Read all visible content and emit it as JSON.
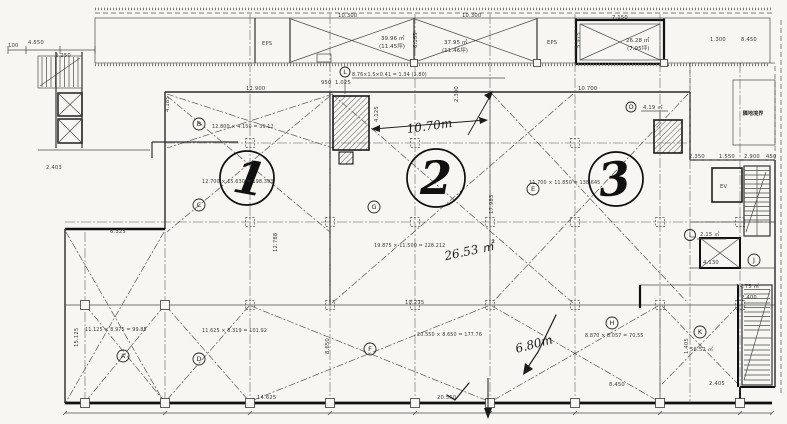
{
  "colors": {
    "paper": "#f7f6f2",
    "ink": "#3b3b3b",
    "ink_heavy": "#111111"
  },
  "annotations": [
    {
      "n": "dim-100",
      "t": "100",
      "x": 8,
      "y": 47,
      "c": "dim"
    },
    {
      "n": "dim-4550",
      "t": "4.550",
      "x": 28,
      "y": 44,
      "c": "dim"
    },
    {
      "n": "dim-2250",
      "t": "2.250",
      "x": 55,
      "y": 57,
      "c": "dim"
    },
    {
      "n": "dim-10300-a",
      "t": "10.300",
      "x": 338,
      "y": 17,
      "c": "dim"
    },
    {
      "n": "dim-10300-b",
      "t": "10.300",
      "x": 462,
      "y": 17,
      "c": "dim"
    },
    {
      "n": "area-bay-a",
      "t": "39.96 ㎡",
      "x": 381,
      "y": 40,
      "c": "area"
    },
    {
      "n": "area-bay-a-tsubo",
      "t": "(11.45坪)",
      "x": 379,
      "y": 48,
      "c": "area"
    },
    {
      "n": "area-bay-b",
      "t": "37.95 ㎡",
      "x": 444,
      "y": 44,
      "c": "area"
    },
    {
      "n": "area-bay-b-tsubo",
      "t": "(11.46坪)",
      "x": 442,
      "y": 52,
      "c": "area"
    },
    {
      "n": "label-eps-left",
      "t": "EPS",
      "x": 262,
      "y": 45,
      "c": "dim"
    },
    {
      "n": "label-eps-mid",
      "t": "EPS",
      "x": 547,
      "y": 44,
      "c": "dim"
    },
    {
      "n": "dim-7150",
      "t": "7.150",
      "x": 612,
      "y": 19,
      "c": "dim"
    },
    {
      "n": "dim-5975",
      "t": "5.975",
      "x": 580,
      "y": 48,
      "c": "dimv"
    },
    {
      "n": "area-box",
      "t": "26.28 ㎡",
      "x": 626,
      "y": 42,
      "c": "area"
    },
    {
      "n": "area-box-tsubo",
      "t": "(7.95坪)",
      "x": 627,
      "y": 50,
      "c": "area"
    },
    {
      "n": "dim-6155",
      "t": "6.155",
      "x": 417,
      "y": 48,
      "c": "dimv"
    },
    {
      "n": "dim-1300",
      "t": "1.300",
      "x": 710,
      "y": 41,
      "c": "dim"
    },
    {
      "n": "dim-8450-top",
      "t": "8.450",
      "x": 741,
      "y": 41,
      "c": "dim"
    },
    {
      "n": "label-kanji-box",
      "t": "隣地境界",
      "x": 753,
      "y": 115,
      "c": "kanji"
    },
    {
      "n": "dim-12900",
      "t": "12.900",
      "x": 246,
      "y": 90,
      "c": "dim"
    },
    {
      "n": "dim-4185",
      "t": "4.185",
      "x": 169,
      "y": 112,
      "c": "dimv"
    },
    {
      "n": "formula-bay-b",
      "t": "12.800 × 4.150 = 39.12",
      "x": 212,
      "y": 128,
      "c": "formula"
    },
    {
      "n": "dim-10700",
      "t": "10.700",
      "x": 578,
      "y": 90,
      "c": "dim"
    },
    {
      "n": "area-shaft-right",
      "t": "4.19 ㎡",
      "x": 643,
      "y": 109,
      "c": "dim"
    },
    {
      "n": "dim-2350",
      "t": "2.350",
      "x": 689,
      "y": 158,
      "c": "dim"
    },
    {
      "n": "dim-1550",
      "t": "1.550",
      "x": 719,
      "y": 158,
      "c": "dim"
    },
    {
      "n": "dim-2900",
      "t": "2.900",
      "x": 744,
      "y": 158,
      "c": "dim"
    },
    {
      "n": "dim-450",
      "t": "450",
      "x": 766,
      "y": 158,
      "c": "dim"
    },
    {
      "n": "shaft-annotation",
      "t": "8.76×1.5×0.41 = 1.34 (3.80)",
      "x": 352,
      "y": 76,
      "c": "formula"
    },
    {
      "n": "dim-950",
      "t": "950",
      "x": 321,
      "y": 84,
      "c": "dim"
    },
    {
      "n": "dim-1025",
      "t": "1.025",
      "x": 335,
      "y": 84,
      "c": "dim"
    },
    {
      "n": "dim-2300",
      "t": "2.300",
      "x": 458,
      "y": 102,
      "c": "dimv"
    },
    {
      "n": "dim-4125",
      "t": "4.125",
      "x": 378,
      "y": 122,
      "c": "dimv"
    },
    {
      "n": "hand-1070",
      "t": "10.70m",
      "x": 430,
      "y": 130,
      "c": "hand",
      "rot": -8
    },
    {
      "n": "zone-circle-1",
      "t": "1",
      "x": 247,
      "y": 194,
      "cy": 178,
      "r": 27,
      "c": "big",
      "rot": 10
    },
    {
      "n": "zone-circle-2",
      "t": "2",
      "x": 436,
      "y": 194,
      "cy": 178,
      "r": 29,
      "c": "big"
    },
    {
      "n": "zone-circle-3",
      "t": "3",
      "x": 616,
      "y": 195,
      "cy": 179,
      "r": 27,
      "c": "big",
      "rot": -6
    },
    {
      "n": "formula-zone-1",
      "t": "12.700 × 15.630 = 198.393",
      "x": 202,
      "y": 183,
      "c": "formula"
    },
    {
      "n": "formula-zone-2",
      "t": "19.875 × 11.500 = 228.212",
      "x": 374,
      "y": 247,
      "c": "formula"
    },
    {
      "n": "formula-zone-3",
      "t": "11.700 × 11.850 = 138.645",
      "x": 529,
      "y": 184,
      "c": "formula"
    },
    {
      "n": "area-room-i",
      "t": "2.15 ㎡",
      "x": 700,
      "y": 236,
      "c": "dim"
    },
    {
      "n": "dim-4130",
      "t": "4.130",
      "x": 703,
      "y": 264,
      "c": "dim"
    },
    {
      "n": "area-room-j",
      "t": "14.75 ㎡",
      "x": 736,
      "y": 288,
      "c": "dim"
    },
    {
      "n": "dim-2400",
      "t": "2.400",
      "x": 741,
      "y": 299,
      "c": "dim"
    },
    {
      "n": "area-room-k",
      "t": "56.52 ㎡",
      "x": 690,
      "y": 351,
      "c": "dim"
    },
    {
      "n": "dim-8450-bottom",
      "t": "8.450",
      "x": 609,
      "y": 386,
      "c": "dim"
    },
    {
      "n": "dim-2405",
      "t": "2.405",
      "x": 709,
      "y": 385,
      "c": "dim"
    },
    {
      "n": "hand-2653",
      "t": "26.53 ㎡",
      "x": 470,
      "y": 255,
      "c": "hand",
      "rot": -12
    },
    {
      "n": "hand-680",
      "t": "6.80m",
      "x": 535,
      "y": 348,
      "c": "hand",
      "rot": -15
    },
    {
      "n": "dim-10275",
      "t": "10.275",
      "x": 405,
      "y": 304,
      "c": "dim"
    },
    {
      "n": "dim-8650",
      "t": "8.650",
      "x": 329,
      "y": 354,
      "c": "dimv"
    },
    {
      "n": "dim-14625",
      "t": "14.625",
      "x": 257,
      "y": 399,
      "c": "dim"
    },
    {
      "n": "dim-20550",
      "t": "20.550",
      "x": 437,
      "y": 399,
      "c": "dim"
    },
    {
      "n": "formula-bay-a2",
      "t": "11.125 × 8.975 = 99.85",
      "x": 85,
      "y": 331,
      "c": "formula"
    },
    {
      "n": "formula-bay-d",
      "t": "11.625 × 8.319 = 101.92",
      "x": 202,
      "y": 332,
      "c": "formula"
    },
    {
      "n": "formula-bay-f",
      "t": "20.550 × 8.650 = 177.76",
      "x": 417,
      "y": 336,
      "c": "formula"
    },
    {
      "n": "formula-bay-h",
      "t": "8.870 × 8.057 = 70.55",
      "x": 585,
      "y": 337,
      "c": "formula"
    },
    {
      "n": "dim-15125",
      "t": "15.125",
      "x": 78,
      "y": 347,
      "c": "dimv"
    },
    {
      "n": "dim-12788",
      "t": "12.788",
      "x": 277,
      "y": 252,
      "c": "dimv"
    },
    {
      "n": "dim-17983",
      "t": "17.983",
      "x": 493,
      "y": 214,
      "c": "dimv"
    },
    {
      "n": "dim-6325",
      "t": "6.325",
      "x": 110,
      "y": 233,
      "c": "dim"
    },
    {
      "n": "dim-2403",
      "t": "2.403",
      "x": 46,
      "y": 169,
      "c": "dim"
    },
    {
      "n": "label-ev",
      "t": "EV",
      "x": 720,
      "y": 188,
      "c": "dim"
    },
    {
      "n": "dim-1405",
      "t": "1.405",
      "x": 688,
      "y": 354,
      "c": "dimv"
    },
    {
      "n": "grid-letter-l",
      "t": "L",
      "x": 345,
      "y": 74,
      "c": "letter",
      "r": 5
    },
    {
      "n": "grid-letter-b",
      "t": "B",
      "x": 199,
      "y": 126,
      "c": "letter",
      "r": 6
    },
    {
      "n": "grid-letter-c",
      "t": "C",
      "x": 199,
      "y": 207,
      "c": "letter",
      "r": 6
    },
    {
      "n": "grid-letter-g",
      "t": "G",
      "x": 374,
      "y": 209,
      "c": "letter",
      "r": 6
    },
    {
      "n": "grid-letter-e",
      "t": "E",
      "x": 533,
      "y": 191,
      "c": "letter",
      "r": 6
    },
    {
      "n": "grid-letter-o",
      "t": "O",
      "x": 631,
      "y": 109,
      "c": "letter",
      "r": 5
    },
    {
      "n": "grid-letter-a",
      "t": "A",
      "x": 123,
      "y": 358,
      "c": "letter",
      "r": 6
    },
    {
      "n": "grid-letter-d",
      "t": "D",
      "x": 199,
      "y": 361,
      "c": "letter",
      "r": 6
    },
    {
      "n": "grid-letter-f",
      "t": "F",
      "x": 370,
      "y": 351,
      "c": "letter",
      "r": 6
    },
    {
      "n": "grid-letter-h",
      "t": "H",
      "x": 612,
      "y": 325,
      "c": "letter",
      "r": 6
    },
    {
      "n": "grid-letter-k",
      "t": "K",
      "x": 700,
      "y": 334,
      "c": "letter",
      "r": 6
    },
    {
      "n": "grid-letter-i",
      "t": "I",
      "x": 690,
      "y": 237,
      "c": "letter",
      "r": 5.5
    },
    {
      "n": "grid-letter-j",
      "t": "J",
      "x": 754,
      "y": 262,
      "c": "letter",
      "r": 6
    }
  ]
}
